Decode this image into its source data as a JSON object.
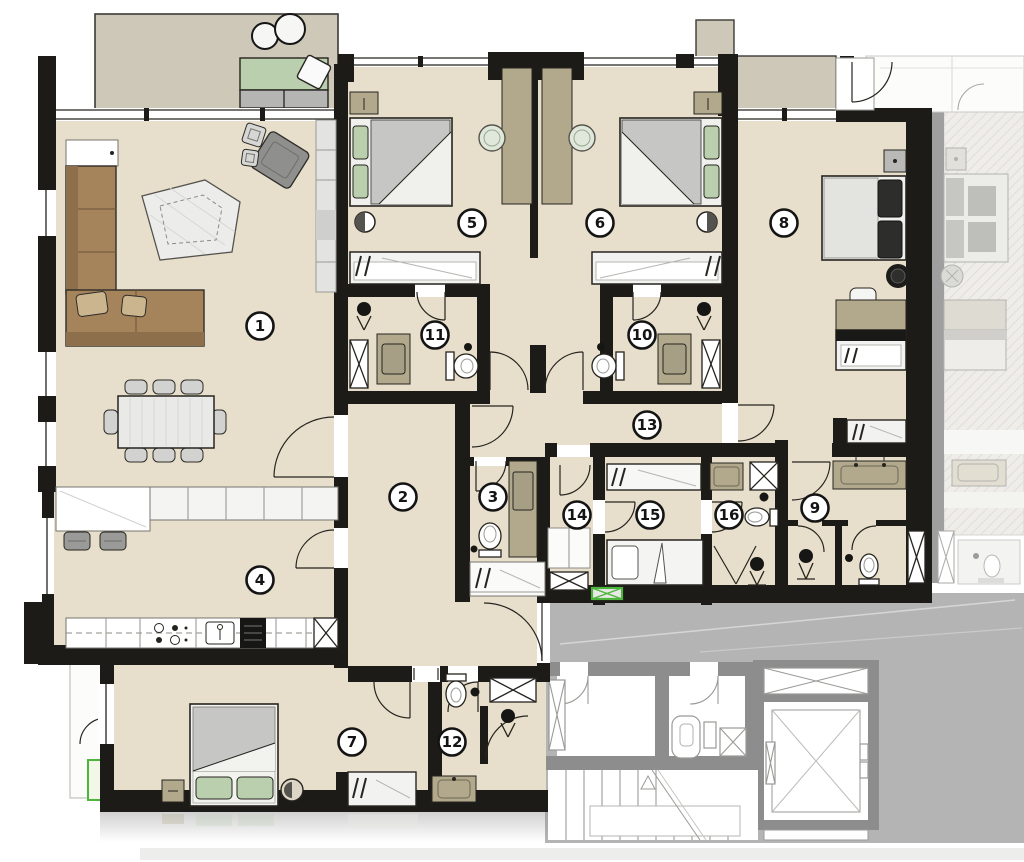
{
  "rooms": [
    {
      "number": "1",
      "x": 260,
      "y": 326
    },
    {
      "number": "2",
      "x": 403,
      "y": 497
    },
    {
      "number": "3",
      "x": 493,
      "y": 497
    },
    {
      "number": "4",
      "x": 260,
      "y": 580
    },
    {
      "number": "5",
      "x": 472,
      "y": 223
    },
    {
      "number": "6",
      "x": 600,
      "y": 223
    },
    {
      "number": "7",
      "x": 352,
      "y": 742
    },
    {
      "number": "8",
      "x": 784,
      "y": 223
    },
    {
      "number": "9",
      "x": 815,
      "y": 508
    },
    {
      "number": "10",
      "x": 642,
      "y": 335
    },
    {
      "number": "11",
      "x": 435,
      "y": 335
    },
    {
      "number": "12",
      "x": 452,
      "y": 742
    },
    {
      "number": "13",
      "x": 647,
      "y": 425
    },
    {
      "number": "14",
      "x": 577,
      "y": 515
    },
    {
      "number": "15",
      "x": 650,
      "y": 515
    },
    {
      "number": "16",
      "x": 729,
      "y": 515
    }
  ],
  "colors": {
    "wall": "#1d1b17",
    "floor": "#e7dfcb",
    "terrace": "#cdc8b8",
    "wood": "#a5835b",
    "wood_dark": "#8d6f4c",
    "cushion_green": "#b9cfae",
    "counter_tan": "#b2a88c",
    "bed_gray": "#c6c6c4",
    "common_wall": "#8d8d8d",
    "landing_gray": "#b4b4b4",
    "panel_green": "#4db53c"
  },
  "icons": [
    "room-number-marker",
    "bed-icon",
    "pillow-icon",
    "wardrobe-hanger-icon",
    "sofa-icon",
    "dining-table-icon",
    "chair-icon",
    "armchair-icon",
    "rug-icon",
    "kitchen-stove-icon",
    "kitchen-sink-icon",
    "toilet-icon",
    "washbasin-icon",
    "shower-head-icon",
    "shaft-x-icon",
    "door-swing-arc",
    "window-band",
    "stairs-icon",
    "elevator-icon",
    "daybed-icon",
    "coffee-table-icon",
    "electrical-panel-icon",
    "desk-icon",
    "bedside-lamp-icon"
  ]
}
